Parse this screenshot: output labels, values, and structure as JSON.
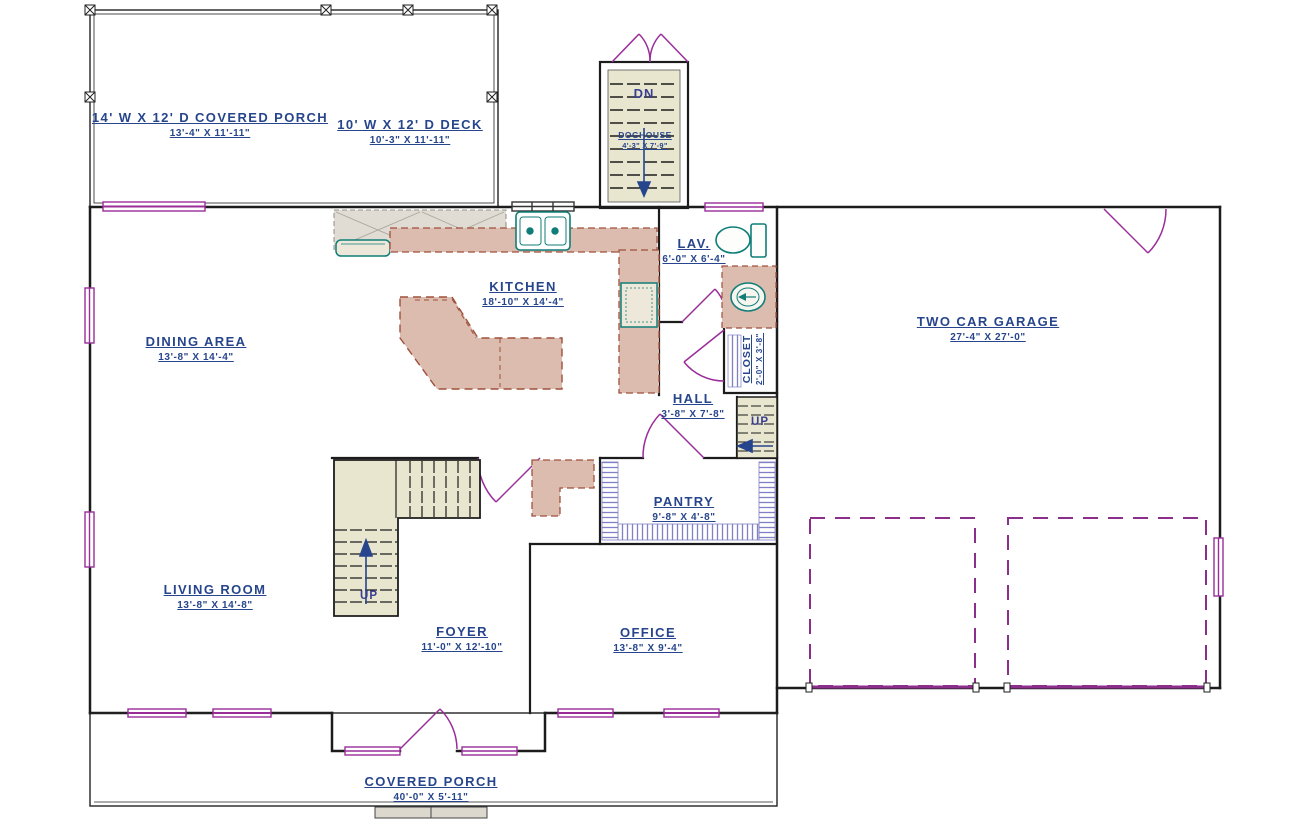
{
  "rooms": {
    "covered_porch_top": {
      "name": "14' W X 12' D COVERED PORCH",
      "dims": "13'-4\" X 11'-11\""
    },
    "deck": {
      "name": "10' W X 12' D DECK",
      "dims": "10'-3\" X 11'-11\""
    },
    "doghouse": {
      "name": "DOGHOUSE",
      "dims": "4'-3\" X 7'-9\""
    },
    "kitchen": {
      "name": "KITCHEN",
      "dims": "18'-10\" X 14'-4\""
    },
    "lav": {
      "name": "LAV.",
      "dims": "6'-0\" X 6'-4\""
    },
    "garage": {
      "name": "TWO CAR GARAGE",
      "dims": "27'-4\" X 27'-0\""
    },
    "dining": {
      "name": "DINING AREA",
      "dims": "13'-8\" X 14'-4\""
    },
    "closet": {
      "name": "CLOSET",
      "dims": "2'-0\" X 3'-8\""
    },
    "hall": {
      "name": "HALL",
      "dims": "3'-8\" X 7'-8\""
    },
    "pantry": {
      "name": "PANTRY",
      "dims": "9'-8\" X 4'-8\""
    },
    "living": {
      "name": "LIVING ROOM",
      "dims": "13'-8\" X 14'-8\""
    },
    "foyer": {
      "name": "FOYER",
      "dims": "11'-0\" X 12'-10\""
    },
    "office": {
      "name": "OFFICE",
      "dims": "13'-8\" X 9'-4\""
    },
    "covered_porch_bottom": {
      "name": "COVERED PORCH",
      "dims": "40'-0\" X 5'-11\""
    }
  },
  "stair_labels": {
    "down": "DN",
    "up": "UP"
  },
  "colors": {
    "label_text": "#26458c",
    "door_window": "#9a2d9a",
    "wall": "#1c1c1c",
    "counter_fill": "#dcbcae",
    "counter_edge": "#a0503c",
    "cabinet_fill": "#e0dcd3",
    "stair_fill": "#e9e6d0",
    "fixture_teal": "#0f7e78",
    "shelf_hatch": "#8080c4"
  }
}
